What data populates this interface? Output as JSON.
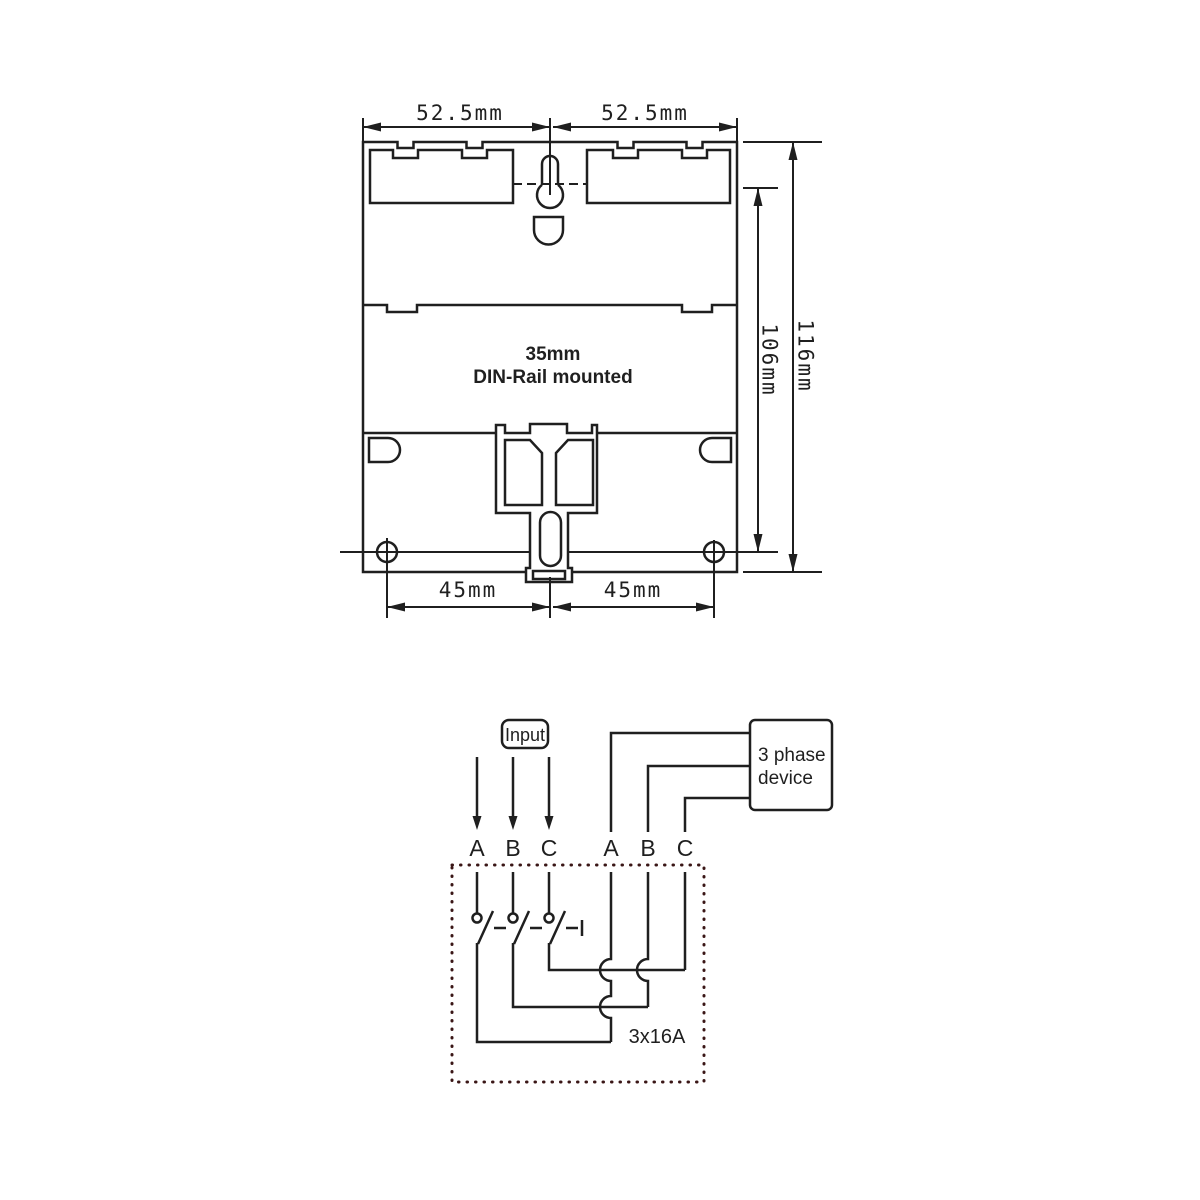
{
  "mechanical_drawing": {
    "dimensions": {
      "top_left": "52.5mm",
      "top_right": "52.5mm",
      "right_outer": "116mm",
      "right_inner": "106mm",
      "bottom_left": "45mm",
      "bottom_right": "45mm"
    },
    "mount_label": {
      "line1": "35mm",
      "line2": "DIN-Rail mounted"
    }
  },
  "wiring_diagram": {
    "input_label": "Input",
    "device_label": {
      "line1": "3 phase",
      "line2": "device"
    },
    "input_phases": [
      "A",
      "B",
      "C"
    ],
    "output_phases": [
      "A",
      "B",
      "C"
    ],
    "switch_rating": "3x16A"
  },
  "colors": {
    "line": "#1f1f1f",
    "dotted_border": "#3a1616",
    "background": "#ffffff"
  }
}
